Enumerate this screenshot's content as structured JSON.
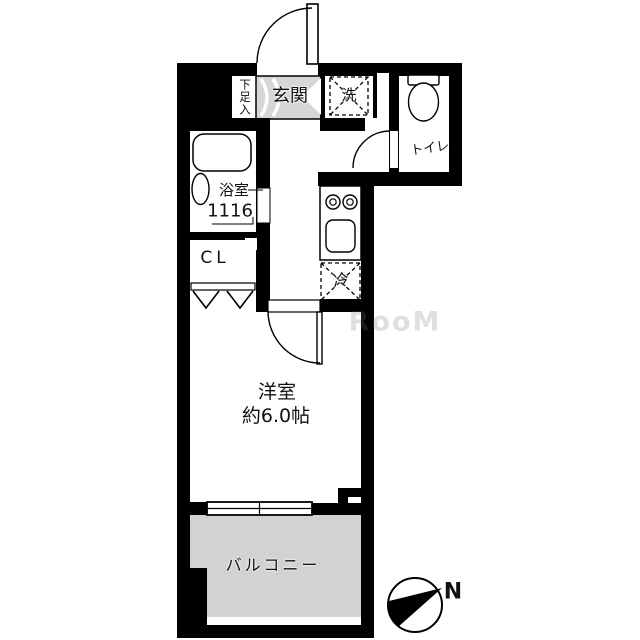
{
  "floorplan": {
    "labels": {
      "shoe_cabinet": "下足入",
      "entrance": "玄関",
      "washer": "洗",
      "toilet": "トイレ",
      "bathroom": "浴室",
      "bathroom_size": "1116",
      "closet": "CL",
      "refrigerator": "冷",
      "room": "洋室",
      "room_size": "約6.0帖",
      "balcony": "バルコニー",
      "compass_north": "N",
      "watermark": "RooM"
    },
    "colors": {
      "wall": "#000000",
      "entrance_floor": "#d6d6d6",
      "balcony_floor": "#d2d2d2",
      "background": "#ffffff"
    }
  }
}
